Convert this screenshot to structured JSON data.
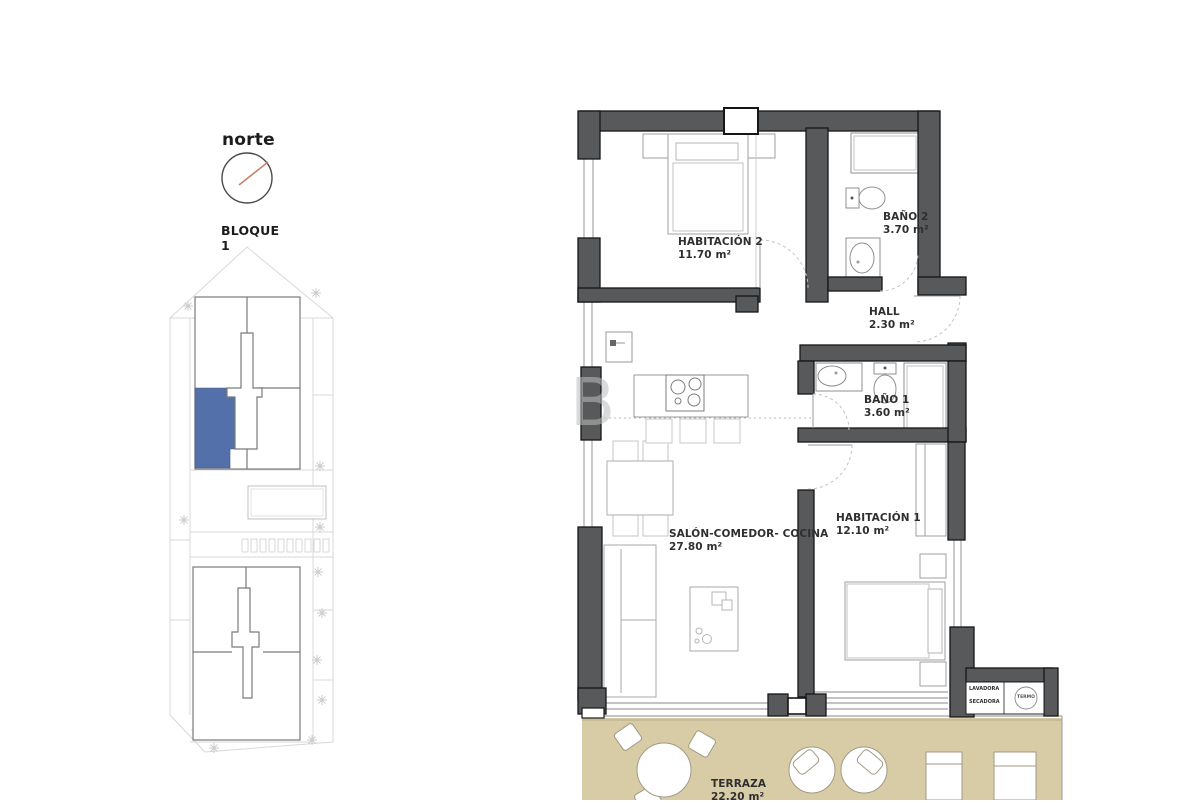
{
  "compass": {
    "label": "norte"
  },
  "site": {
    "block_label": "BLOQUE 1"
  },
  "watermark": {
    "letter": "B"
  },
  "rooms": [
    {
      "name": "HABITACIÓN 2",
      "area": "11.70 m²"
    },
    {
      "name": "BAÑO 2",
      "area": "3.70 m²"
    },
    {
      "name": "HALL",
      "area": "2.30 m²"
    },
    {
      "name": "BAÑO 1",
      "area": "3.60 m²"
    },
    {
      "name": "HABITACIÓN 1",
      "area": "12.10 m²"
    },
    {
      "name": "SALÓN-COMEDOR- COCINA",
      "area": "27.80 m²"
    },
    {
      "name": "TERRAZA",
      "area": "22.20 m²"
    }
  ],
  "utility": {
    "washer": "LAVADORA",
    "dryer": "SECADORA",
    "heater": "TERMO"
  },
  "colors": {
    "wall": "#58595b",
    "terrace": "#d8cca6",
    "unit_highlight": "#5470ab",
    "compass_needle": "#c8826b"
  }
}
